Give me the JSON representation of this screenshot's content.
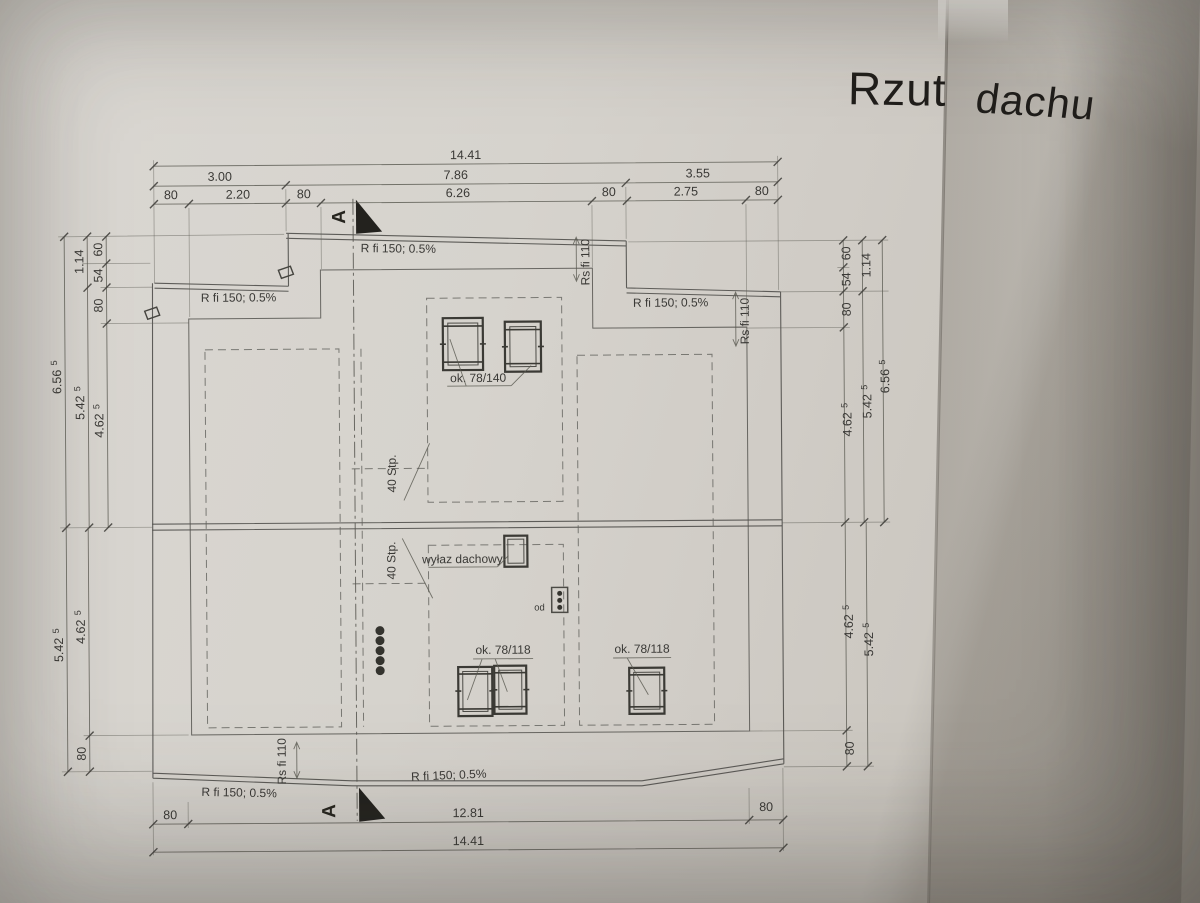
{
  "title": {
    "word1": "Rzut",
    "word2": "dachu"
  },
  "labels": {
    "gutter": "R fi 150; 0.5%",
    "downpipe": "Rs fi 110",
    "roof_window_top": "ok. 78/140",
    "roof_window_bottom": "ok. 78/118",
    "roof_hatch": "wyłaz dachowy",
    "slope": "40 Stp.",
    "vent": "od",
    "section": "A"
  },
  "dims": {
    "top": {
      "total": "14.41",
      "seg_left": "3.00",
      "seg_mid": "7.86",
      "seg_right": "3.55",
      "sub": [
        "80",
        "2.20",
        "80",
        "6.26",
        "80",
        "2.75",
        "80"
      ]
    },
    "bottom": {
      "left_eave": "80",
      "inner": "12.81",
      "right_eave": "80",
      "total": "14.41"
    },
    "side_upper": {
      "outer": "6.56",
      "outer_sup": "5",
      "mid": "5.42",
      "mid_sup": "5",
      "inner": "4.62",
      "inner_sup": "5",
      "span": "1.14",
      "seg1": "60",
      "seg2": "54",
      "seg3": "80"
    },
    "side_lower": {
      "outer": "5.42",
      "outer_sup": "5",
      "inner": "4.62",
      "inner_sup": "5",
      "eave": "80"
    }
  }
}
